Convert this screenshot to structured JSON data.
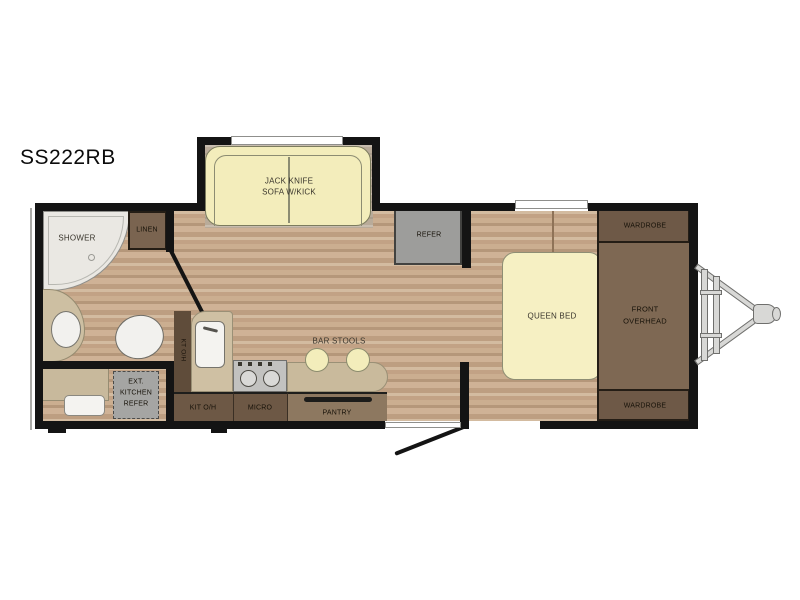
{
  "title": "SS222RB",
  "colors": {
    "wall": "#141414",
    "floor_wood": "#c6a98c",
    "furniture_yellow": "#f3edbb",
    "cabinet_dark_brown": "#6e5947",
    "cabinet_mid_brown": "#7e6853",
    "appliance_gray": "#9d9d9b",
    "counter_tan": "#c9ba9c",
    "fixture_white": "#f2f1ee"
  },
  "labels": {
    "shower": "SHOWER",
    "linen": "LINEN",
    "med_cab": "MED CAB",
    "sofa_line1": "JACK KNIFE",
    "sofa_line2": "SOFA W/KICK",
    "refer": "REFER",
    "bar_stools": "BAR STOOLS",
    "queen_bed": "QUEEN BED",
    "wardrobe_top": "WARDROBE",
    "overhead_line1": "FRONT",
    "overhead_line2": "OVERHEAD",
    "wardrobe_bottom": "WARDROBE",
    "ext_kitchen_line1": "EXT.",
    "ext_kitchen_line2": "KITCHEN",
    "ext_kitchen_line3": "REFER",
    "kit_overhead_vertical": "KT O/H",
    "kit_overhead": "KIT O/H",
    "micro": "MICRO",
    "pantry": "PANTRY"
  }
}
